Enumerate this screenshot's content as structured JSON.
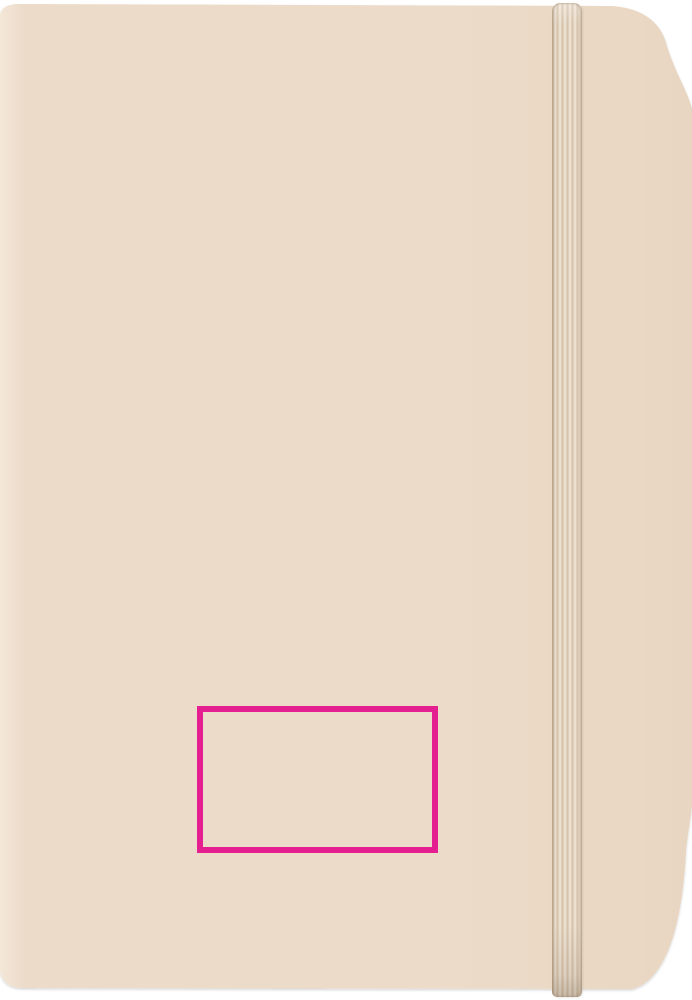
{
  "scene": {
    "description": "Blank beige soft-cover notebook, portrait orientation, with a matching vertical elastic closure band near the right edge; a magenta rectangle outline marks the print area on the lower part of the cover",
    "background_color": "#ffffff"
  },
  "notebook": {
    "cover_spine_color": "#f4e7d8",
    "cover_base_color": "#ecdbc9",
    "cover_edge_color": "#e9d6c2",
    "band_base_color": "#e2d1bd",
    "band_rib_color": "#eee2d2",
    "band_groove_color": "#d6c4ae"
  },
  "print_area": {
    "outline_color": "#e51f8f"
  }
}
